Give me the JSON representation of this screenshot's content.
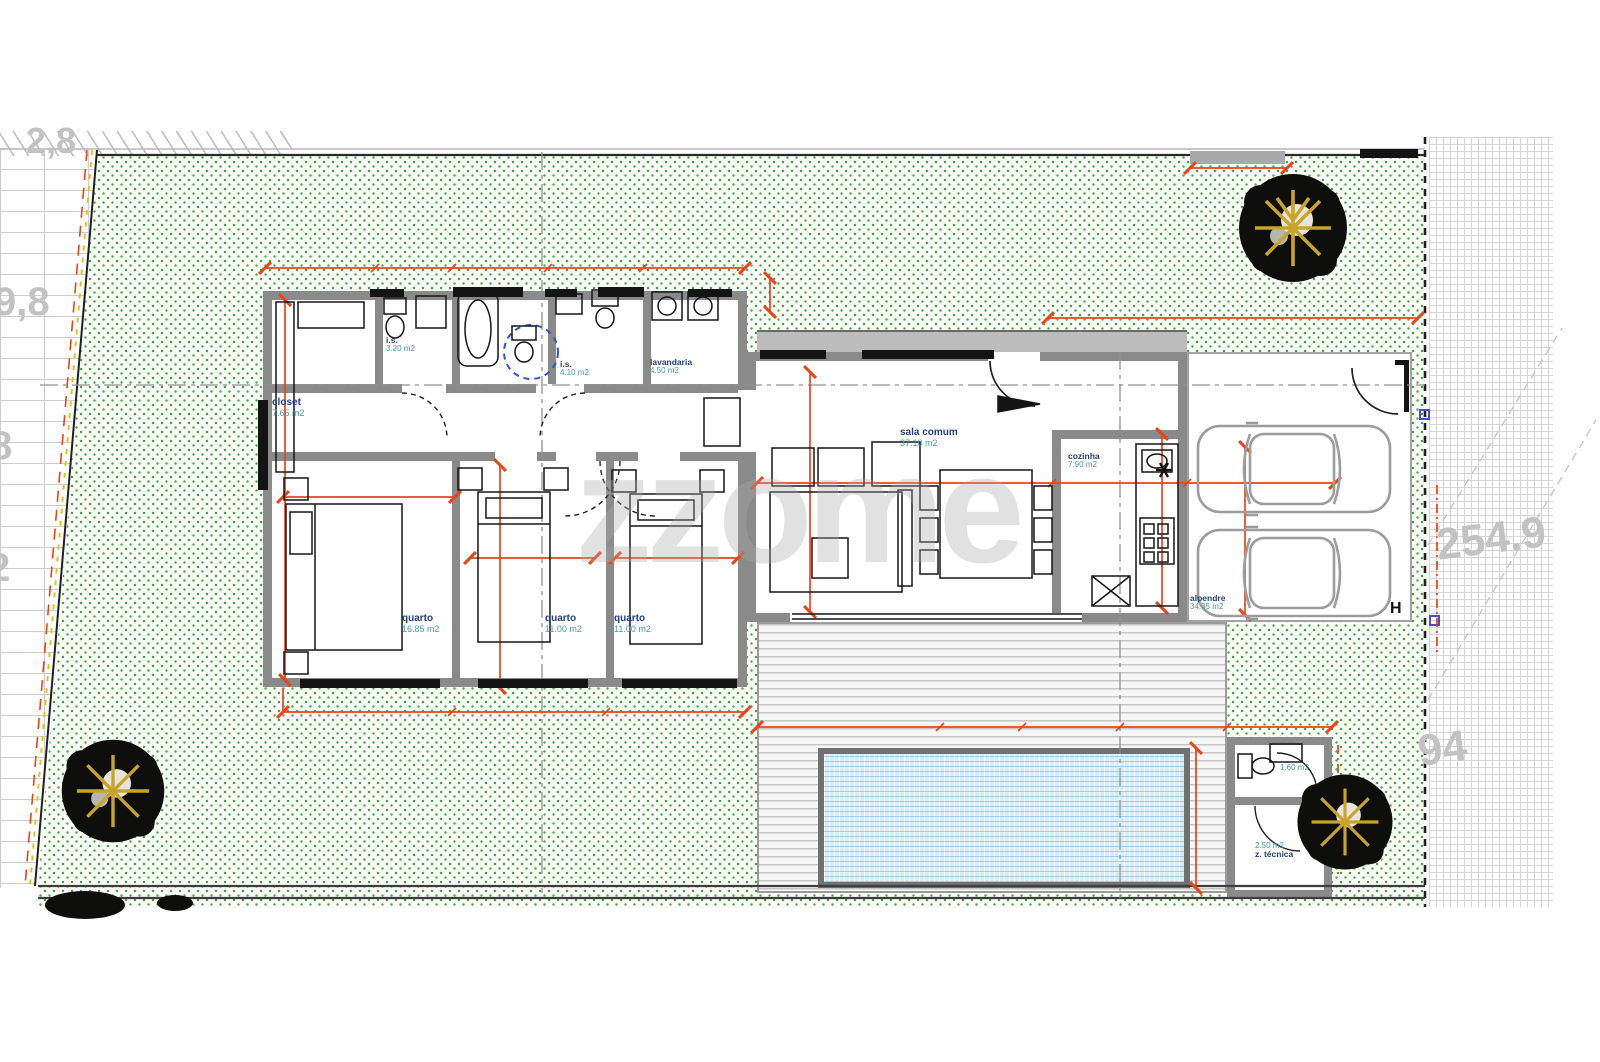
{
  "drawing": {
    "watermark": "zzome",
    "annotation_h": "H"
  },
  "rooms": {
    "closet": {
      "name": "closet",
      "area": "7.65 m2"
    },
    "is_top": {
      "name": "i.s.",
      "area": "3.20 m2"
    },
    "is_mid": {
      "name": "i.s.",
      "area": "4.10 m2"
    },
    "lavandaria": {
      "name": "lavandaria",
      "area": "4.50 m2"
    },
    "quarto_1": {
      "name": "quarto",
      "area": "16.85 m2"
    },
    "quarto_2": {
      "name": "quarto",
      "area": "11.00 m2"
    },
    "quarto_3": {
      "name": "quarto",
      "area": "11.00 m2"
    },
    "sala": {
      "name": "sala comum",
      "area": "37.10 m2"
    },
    "cozinha": {
      "name": "cozinha",
      "area": "7.90 m2"
    },
    "alpendre": {
      "name": "alpendre",
      "area": "34.35 m2"
    },
    "wc_piscina": {
      "area": "1.60 m2"
    },
    "zona_tecnica": {
      "name": "z. técnica",
      "area": "2.50 m2"
    }
  },
  "site": {
    "left_levels": [
      "2,8",
      "9,8",
      "8",
      "2"
    ],
    "right_levels": [
      "254.9",
      "94"
    ]
  },
  "colors": {
    "dimension_red": "#e8441a",
    "wall_grey": "#8a8a8a",
    "garden_green": "#57a557",
    "pool_blue": "#d8edf8",
    "label_navy": "#24417d",
    "label_teal": "#4d9aa8"
  }
}
